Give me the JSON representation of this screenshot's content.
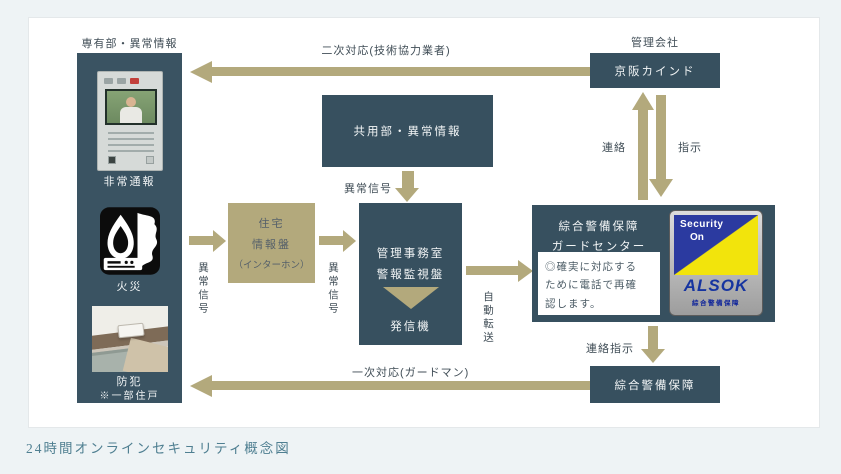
{
  "caption": "24時間オンラインセキュリティ概念図",
  "colors": {
    "box_teal": "#37505f",
    "arrow_khaki": "#b3a97c",
    "alsok_blue": "#2b3aa0",
    "alsok_yellow": "#f2e40c"
  },
  "left_panel": {
    "title": "専有部・異常情報",
    "emergency_label": "非常通報",
    "fire_label": "火災",
    "crime_label": "防犯",
    "crime_note": "※一部住戸"
  },
  "boxes": {
    "common_area": "共用部・異常情報",
    "residence_panel": {
      "line1": "住宅",
      "line2": "情報盤",
      "line3": "（インターホン）"
    },
    "management_office": {
      "line1": "管理事務室",
      "line2": "警報監視盤",
      "line3": "発信機"
    },
    "management_company_label": "管理会社",
    "keihan": "京阪カインド",
    "guard_center": {
      "line1": "綜合警備保障",
      "line2": "ガードセンター",
      "note_line1": "◎確実に対応する",
      "note_line2": "ために電話で再確",
      "note_line3": "認します。"
    },
    "security_company": "綜合警備保障"
  },
  "alsok_sticker": {
    "line1": "Security",
    "line2": "On",
    "logo": "ALSOK",
    "sub": "綜合警備保障"
  },
  "arrow_labels": {
    "secondary_response": "二次対応(技術協力業者)",
    "abnormal_signal": "異常信号",
    "auto_transfer": "自動転送",
    "contact": "連絡",
    "instruction": "指示",
    "contact_instruction": "連絡指示",
    "primary_response": "一次対応(ガードマン)"
  }
}
